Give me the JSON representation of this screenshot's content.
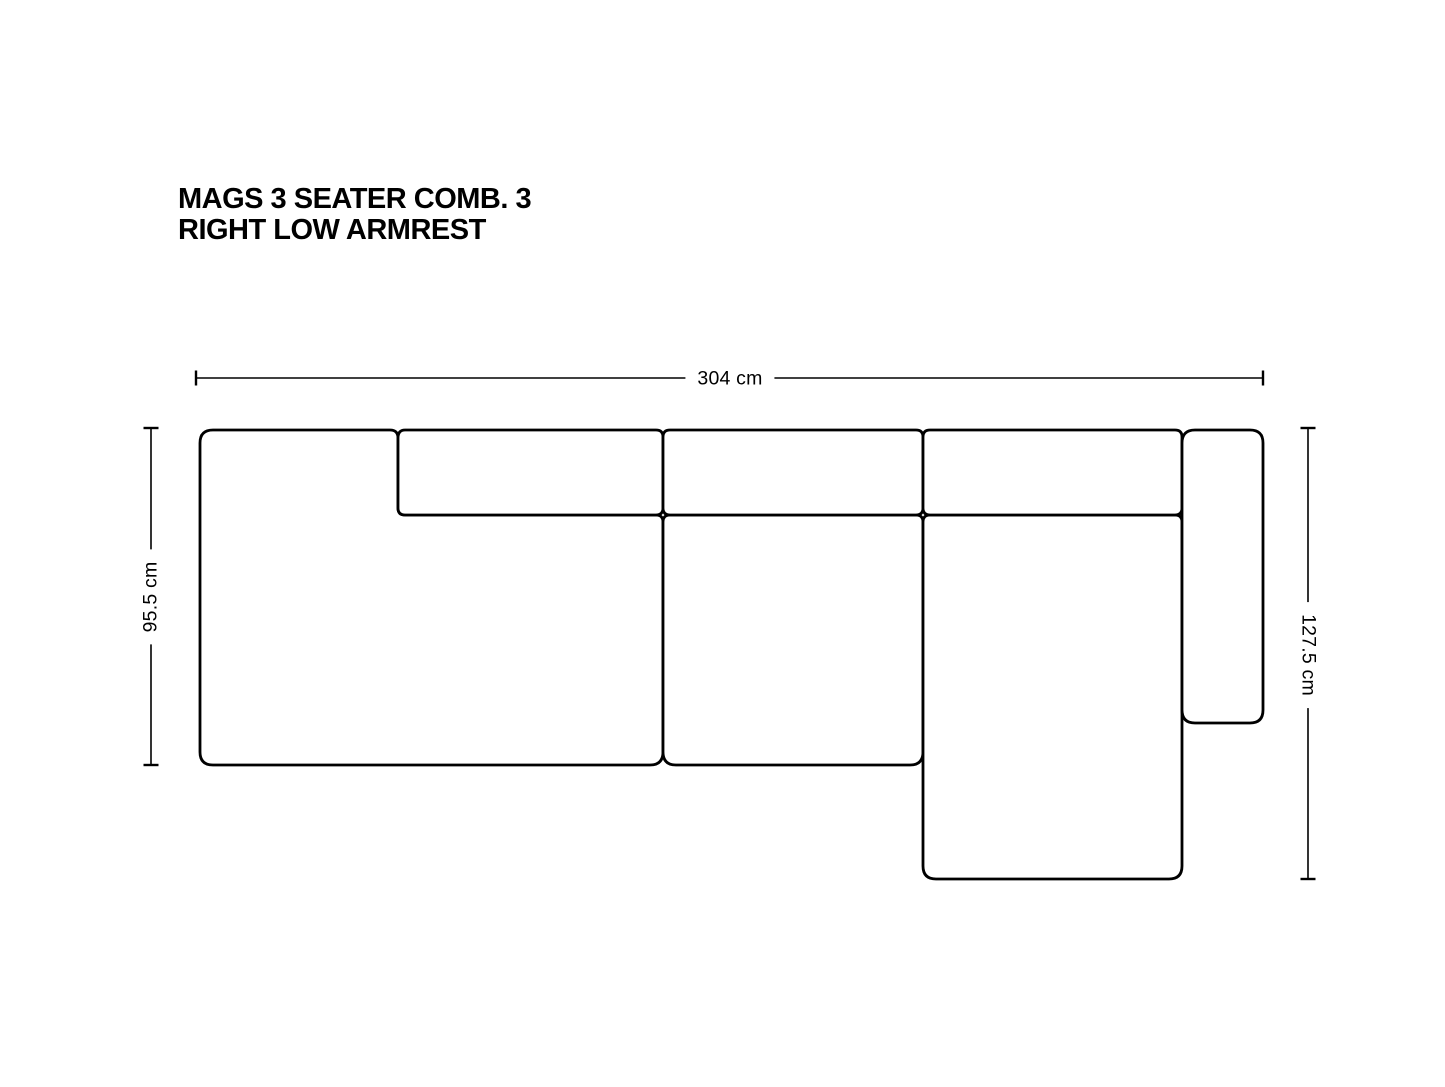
{
  "page": {
    "background_color": "#ffffff"
  },
  "product": {
    "title_line1": "MAGS 3 SEATER COMB. 3",
    "title_line2": "RIGHT LOW ARMREST"
  },
  "dimensions": {
    "width": "304 cm",
    "left_height": "95.5 cm",
    "right_height": "127.5 cm"
  },
  "diagram": {
    "type": "top-view sofa line drawing",
    "line_color": "#000000",
    "text_color": "#000000"
  }
}
